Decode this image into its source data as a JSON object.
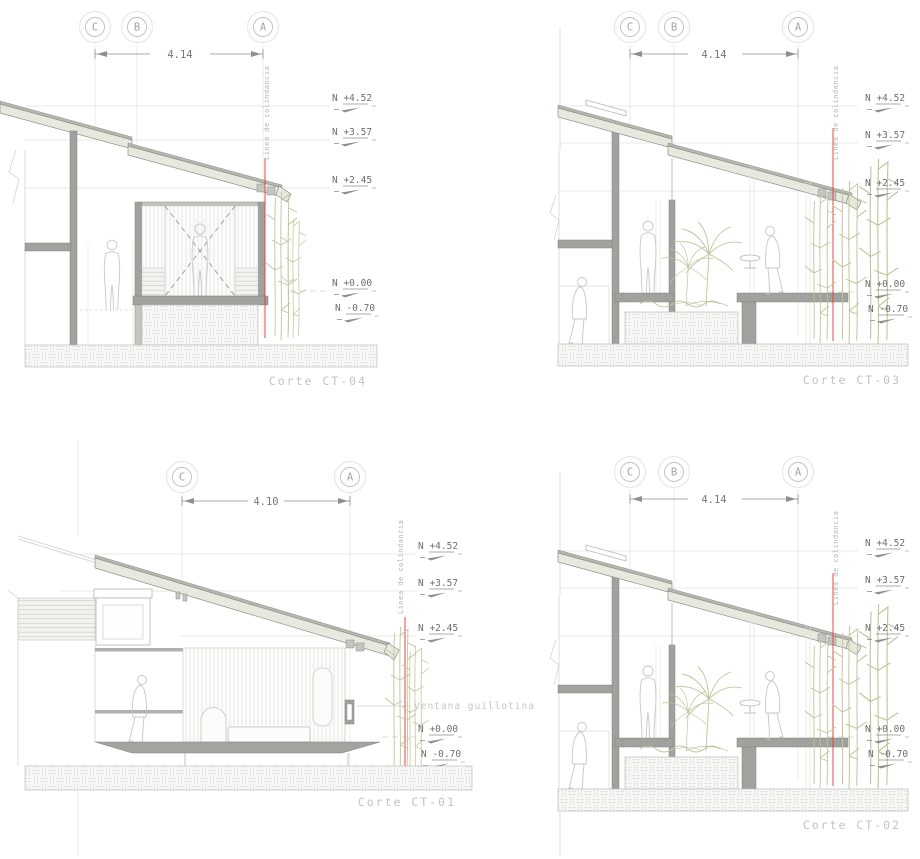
{
  "colors": {
    "background": "#ffffff",
    "wall_fill": "#a1a19e",
    "roof_fill": "#e9e8df",
    "roof_edge": "#b7b6af",
    "boundary_line_red": "#d84b40",
    "vegetation_green": "#c0c49a",
    "annotation_gray": "#6f6f6d",
    "label_gray": "#c3c3c0",
    "construction_line": "#d6d6d3"
  },
  "sections": {
    "ct04": {
      "name": "Corte CT-04",
      "grid": [
        "C",
        "B",
        "A"
      ],
      "dim": "4.14",
      "levels": [
        "N +4.52",
        "N +3.57",
        "N +2.45",
        "N +0.00",
        "N -0.70"
      ],
      "boundary": "Línea de colindancia"
    },
    "ct03": {
      "name": "Corte CT-03",
      "grid": [
        "C",
        "B",
        "A"
      ],
      "dim": "4.14",
      "levels": [
        "N +4.52",
        "N +3.57",
        "N +2.45",
        "N +0.00",
        "N -0.70"
      ],
      "boundary": "Línea de colindancia"
    },
    "ct01": {
      "name": "Corte CT-01",
      "grid": [
        "C",
        "A"
      ],
      "dim": "4.10",
      "levels": [
        "N +4.52",
        "N +3.57",
        "N +2.45",
        "N +0.00",
        "N -0.70"
      ],
      "boundary": "Línea de colindancia",
      "annotation": "Ventana guillotina"
    },
    "ct02": {
      "name": "Corte CT-02",
      "grid": [
        "C",
        "B",
        "A"
      ],
      "dim": "4.14",
      "levels": [
        "N +4.52",
        "N +3.57",
        "N +2.45",
        "N +0.00",
        "N -0.70"
      ],
      "boundary": "Línea de colindancia"
    }
  }
}
